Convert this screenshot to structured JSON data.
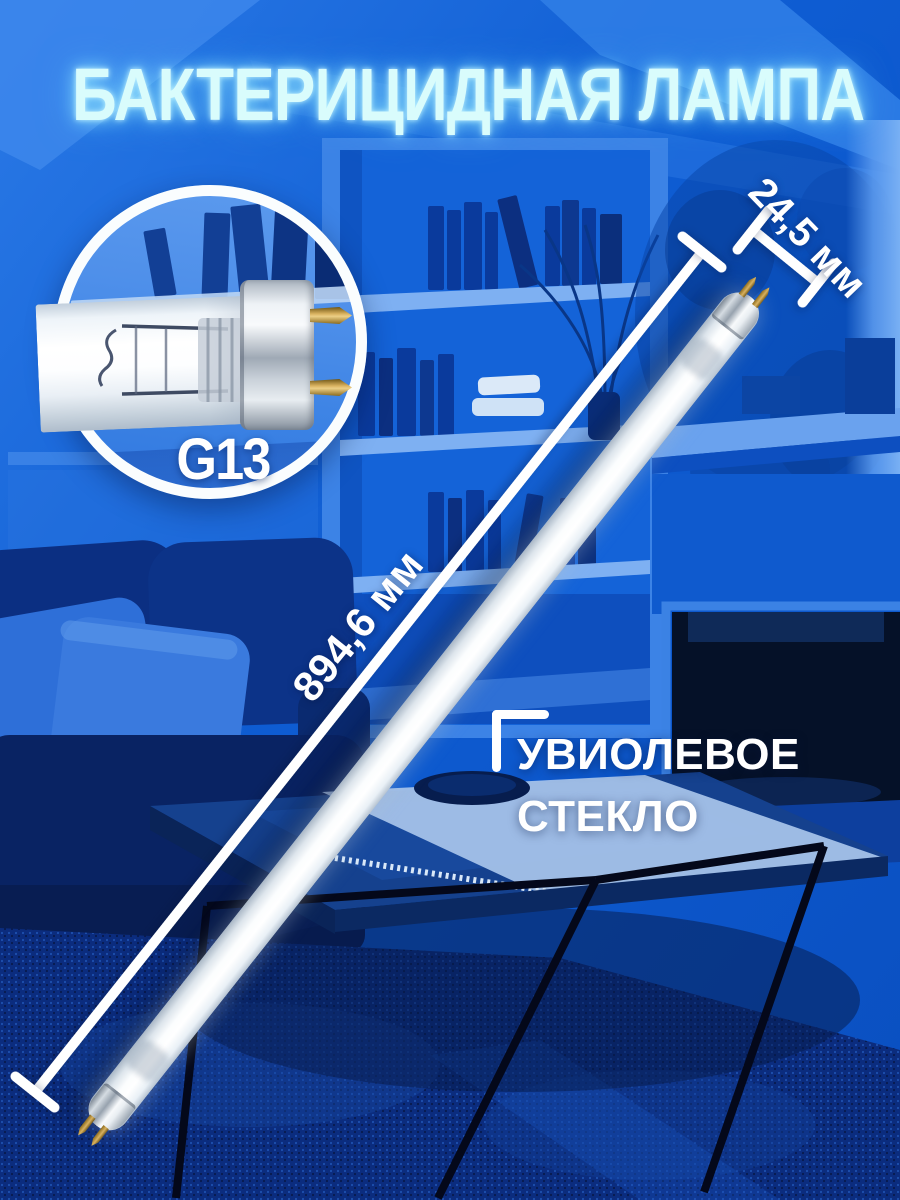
{
  "title": "БАКТЕРИЦИДНАЯ ЛАМПА",
  "inset": {
    "socket_label": "G13"
  },
  "dimensions": {
    "diameter_label": "24,5 мм",
    "length_label": "894,6 мм"
  },
  "callout": {
    "line1": "УВИОЛЕВОЕ",
    "line2": "СТЕКЛО"
  },
  "colors": {
    "wall_blue": "#0e5cd2",
    "deep_navy": "#0a2c7c",
    "annotation_white": "#ffffff",
    "title_cyan": "#d9fcfc",
    "brass_pin": "#caa24b",
    "fireplace_dark": "#051128"
  },
  "icons": {
    "callout_bracket": "corner-bracket",
    "dimension_endcap": "t-bar"
  }
}
